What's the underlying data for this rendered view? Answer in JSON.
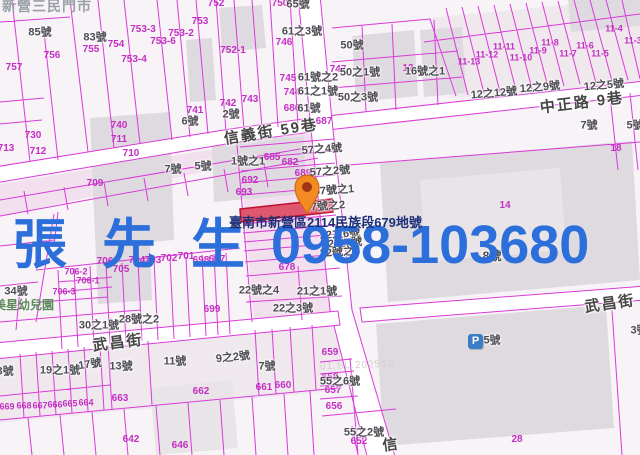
{
  "colors": {
    "line": "#d93ad9",
    "magenta_text": "#c32ec3",
    "house_text": "#4c4c52",
    "road": "#ffffff",
    "parcel": "#f8f3f7",
    "building": "#dfdadf",
    "tint": "#f3e0ee",
    "highlight_fill": "#e0566e",
    "highlight_stroke": "#bf0f2f",
    "watermark_blue": "#2c6fdb",
    "address_navy": "#1c2f77",
    "poi_green": "#5c8a5c",
    "store_grey": "#9aa0a8",
    "pin_orange": "#f28b22",
    "parking_blue": "#3b7ec8"
  },
  "watermark": {
    "name": "張 先 生",
    "phone": "0958-103680"
  },
  "address_overlay": "臺南市新營區2114民族段679地號",
  "store_name": "新營三民門市",
  "kindergarten": "美星幼兒園",
  "stamp": "01.SL.202510",
  "parking": {
    "letter": "P"
  },
  "labels": {
    "streets": [
      {
        "t": "信義街 59巷",
        "x": 271,
        "y": 132,
        "r": -9
      },
      {
        "t": "中正路 9巷",
        "x": 582,
        "y": 103,
        "r": -7
      },
      {
        "t": "武昌街",
        "x": 118,
        "y": 343,
        "r": -7
      },
      {
        "t": "武昌街",
        "x": 610,
        "y": 304,
        "r": -8
      },
      {
        "t": "信",
        "x": 391,
        "y": 445,
        "r": -8
      }
    ],
    "magenta": [
      {
        "t": "752",
        "x": 216,
        "y": 4
      },
      {
        "t": "750",
        "x": 280,
        "y": 4
      },
      {
        "t": "753",
        "x": 200,
        "y": 22
      },
      {
        "t": "753-3",
        "x": 143,
        "y": 30
      },
      {
        "t": "753-2",
        "x": 181,
        "y": 34
      },
      {
        "t": "753-6",
        "x": 163,
        "y": 42
      },
      {
        "t": "753-4",
        "x": 134,
        "y": 60
      },
      {
        "t": "752-1",
        "x": 233,
        "y": 51
      },
      {
        "t": "754",
        "x": 116,
        "y": 45
      },
      {
        "t": "755",
        "x": 91,
        "y": 50
      },
      {
        "t": "756",
        "x": 52,
        "y": 56
      },
      {
        "t": "757",
        "x": 14,
        "y": 68
      },
      {
        "t": "746",
        "x": 284,
        "y": 43
      },
      {
        "t": "747",
        "x": 338,
        "y": 70
      },
      {
        "t": "745",
        "x": 288,
        "y": 79
      },
      {
        "t": "744",
        "x": 292,
        "y": 93
      },
      {
        "t": "686",
        "x": 292,
        "y": 109
      },
      {
        "t": "687",
        "x": 324,
        "y": 122
      },
      {
        "t": "743",
        "x": 250,
        "y": 100
      },
      {
        "t": "742",
        "x": 228,
        "y": 104
      },
      {
        "t": "741",
        "x": 195,
        "y": 111
      },
      {
        "t": "740",
        "x": 119,
        "y": 126
      },
      {
        "t": "730",
        "x": 33,
        "y": 136
      },
      {
        "t": "711",
        "x": 119,
        "y": 140
      },
      {
        "t": "712",
        "x": 38,
        "y": 152
      },
      {
        "t": "713",
        "x": 6,
        "y": 149
      },
      {
        "t": "710",
        "x": 131,
        "y": 154
      },
      {
        "t": "709",
        "x": 95,
        "y": 184
      },
      {
        "t": "685",
        "x": 272,
        "y": 158
      },
      {
        "t": "682",
        "x": 290,
        "y": 163
      },
      {
        "t": "689",
        "x": 303,
        "y": 174
      },
      {
        "t": "692",
        "x": 250,
        "y": 181
      },
      {
        "t": "693",
        "x": 244,
        "y": 193
      },
      {
        "t": "678",
        "x": 287,
        "y": 268
      },
      {
        "t": "699",
        "x": 212,
        "y": 310
      },
      {
        "t": "706-2",
        "x": 76,
        "y": 272,
        "s": 9
      },
      {
        "t": "706-1",
        "x": 88,
        "y": 281,
        "s": 9
      },
      {
        "t": "706-3",
        "x": 64,
        "y": 292,
        "s": 9
      },
      {
        "t": "706",
        "x": 105,
        "y": 262
      },
      {
        "t": "705",
        "x": 121,
        "y": 270
      },
      {
        "t": "704",
        "x": 137,
        "y": 261
      },
      {
        "t": "703",
        "x": 153,
        "y": 261
      },
      {
        "t": "702",
        "x": 169,
        "y": 259
      },
      {
        "t": "701",
        "x": 186,
        "y": 257
      },
      {
        "t": "698",
        "x": 201,
        "y": 261
      },
      {
        "t": "697",
        "x": 217,
        "y": 260
      },
      {
        "t": "663",
        "x": 120,
        "y": 399
      },
      {
        "t": "662",
        "x": 201,
        "y": 392
      },
      {
        "t": "661",
        "x": 264,
        "y": 388
      },
      {
        "t": "660",
        "x": 283,
        "y": 386
      },
      {
        "t": "669",
        "x": 7,
        "y": 407,
        "s": 9
      },
      {
        "t": "668",
        "x": 24,
        "y": 406,
        "s": 9
      },
      {
        "t": "667",
        "x": 40,
        "y": 406,
        "s": 9
      },
      {
        "t": "666",
        "x": 55,
        "y": 405,
        "s": 9
      },
      {
        "t": "665",
        "x": 70,
        "y": 404,
        "s": 9
      },
      {
        "t": "664",
        "x": 86,
        "y": 403,
        "s": 9
      },
      {
        "t": "642",
        "x": 131,
        "y": 440
      },
      {
        "t": "646",
        "x": 180,
        "y": 446
      },
      {
        "t": "659",
        "x": 330,
        "y": 353
      },
      {
        "t": "658",
        "x": 330,
        "y": 378
      },
      {
        "t": "657",
        "x": 333,
        "y": 391
      },
      {
        "t": "656",
        "x": 334,
        "y": 407
      },
      {
        "t": "652",
        "x": 359,
        "y": 442
      },
      {
        "t": "28",
        "x": 517,
        "y": 440
      },
      {
        "t": "18",
        "x": 616,
        "y": 149
      },
      {
        "t": "12",
        "x": 408,
        "y": 69
      },
      {
        "t": "14",
        "x": 505,
        "y": 206
      },
      {
        "t": "11-13",
        "x": 469,
        "y": 62,
        "s": 9
      },
      {
        "t": "11-12",
        "x": 487,
        "y": 55,
        "s": 9
      },
      {
        "t": "11-11",
        "x": 504,
        "y": 47,
        "s": 9
      },
      {
        "t": "11-10",
        "x": 521,
        "y": 58,
        "s": 9
      },
      {
        "t": "11-9",
        "x": 538,
        "y": 51,
        "s": 9
      },
      {
        "t": "11-8",
        "x": 550,
        "y": 43,
        "s": 9
      },
      {
        "t": "11-7",
        "x": 568,
        "y": 54,
        "s": 9
      },
      {
        "t": "11-6",
        "x": 585,
        "y": 46,
        "s": 9
      },
      {
        "t": "11-5",
        "x": 600,
        "y": 54,
        "s": 9
      },
      {
        "t": "11-4",
        "x": 614,
        "y": 29,
        "s": 9
      },
      {
        "t": "11-3",
        "x": 633,
        "y": 41,
        "s": 9
      }
    ],
    "houses": [
      {
        "t": "85號",
        "x": 40,
        "y": 33
      },
      {
        "t": "83號",
        "x": 95,
        "y": 38
      },
      {
        "t": "65號",
        "x": 298,
        "y": 5
      },
      {
        "t": "61之3號",
        "x": 302,
        "y": 32
      },
      {
        "t": "61號之2",
        "x": 318,
        "y": 78
      },
      {
        "t": "61之1號",
        "x": 318,
        "y": 92
      },
      {
        "t": "61號",
        "x": 309,
        "y": 109
      },
      {
        "t": "50號",
        "x": 352,
        "y": 46
      },
      {
        "t": "50之1號",
        "x": 360,
        "y": 73
      },
      {
        "t": "50之3號",
        "x": 358,
        "y": 98
      },
      {
        "t": "16號之1",
        "x": 425,
        "y": 72
      },
      {
        "t": "12之12號",
        "x": 494,
        "y": 94,
        "r": -5
      },
      {
        "t": "12之9號",
        "x": 540,
        "y": 88,
        "r": -5
      },
      {
        "t": "12之5號",
        "x": 604,
        "y": 86,
        "r": -5
      },
      {
        "t": "7號",
        "x": 589,
        "y": 126
      },
      {
        "t": "5號",
        "x": 635,
        "y": 126
      },
      {
        "t": "2號",
        "x": 231,
        "y": 115
      },
      {
        "t": "6號",
        "x": 190,
        "y": 122
      },
      {
        "t": "7號",
        "x": 173,
        "y": 170
      },
      {
        "t": "5號",
        "x": 203,
        "y": 167
      },
      {
        "t": "1號之1",
        "x": 248,
        "y": 162
      },
      {
        "t": "57之4號",
        "x": 322,
        "y": 150,
        "r": -4
      },
      {
        "t": "57之2號",
        "x": 330,
        "y": 172,
        "r": -4
      },
      {
        "t": "57號之1",
        "x": 334,
        "y": 191,
        "r": -4
      },
      {
        "t": "57號之2",
        "x": 325,
        "y": 207,
        "r": -4
      },
      {
        "t": "22之6號",
        "x": 340,
        "y": 235,
        "r": -4
      },
      {
        "t": "22之7號",
        "x": 342,
        "y": 244,
        "r": -4
      },
      {
        "t": "22號之8",
        "x": 340,
        "y": 253,
        "r": -4
      },
      {
        "t": "8號",
        "x": 492,
        "y": 256,
        "s": 12
      },
      {
        "t": "22號之4",
        "x": 259,
        "y": 291
      },
      {
        "t": "21之1號",
        "x": 317,
        "y": 292
      },
      {
        "t": "22之3號",
        "x": 293,
        "y": 309
      },
      {
        "t": "34號",
        "x": 16,
        "y": 292
      },
      {
        "t": "30之1號",
        "x": 99,
        "y": 326
      },
      {
        "t": "28號之2",
        "x": 139,
        "y": 320
      },
      {
        "t": "23號",
        "x": 2,
        "y": 372
      },
      {
        "t": "19之1號",
        "x": 60,
        "y": 371
      },
      {
        "t": "17號",
        "x": 90,
        "y": 365,
        "r": -8
      },
      {
        "t": "13號",
        "x": 121,
        "y": 367
      },
      {
        "t": "11號",
        "x": 175,
        "y": 362
      },
      {
        "t": "9之2號",
        "x": 233,
        "y": 358,
        "r": -6
      },
      {
        "t": "7號",
        "x": 267,
        "y": 367
      },
      {
        "t": "55之6號",
        "x": 340,
        "y": 382
      },
      {
        "t": "55之2號",
        "x": 364,
        "y": 433
      },
      {
        "t": "5號",
        "x": 492,
        "y": 341
      },
      {
        "t": "3號",
        "x": 639,
        "y": 331
      }
    ]
  }
}
